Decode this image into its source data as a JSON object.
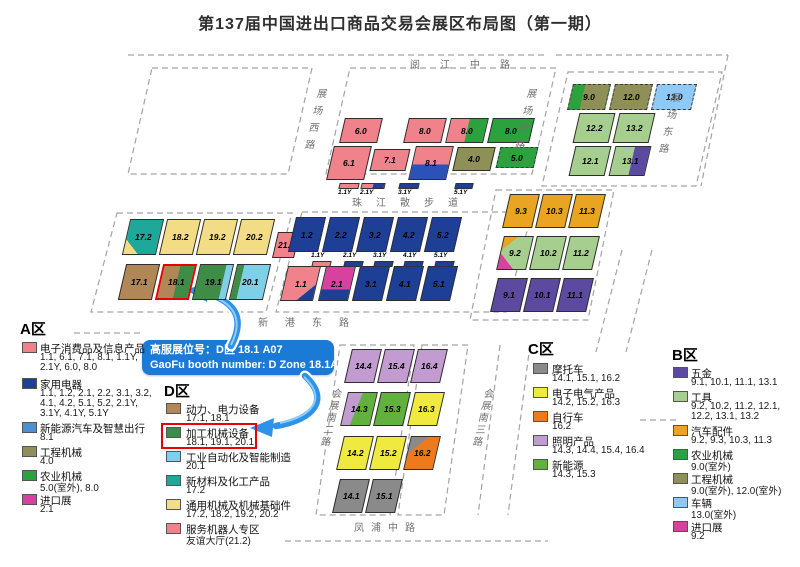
{
  "title": "第137届中国进出口商品交易会展区布局图（第一期）",
  "callout": {
    "x": 142,
    "y": 340,
    "w": 192,
    "h": 35,
    "bg": "#1B7AD6",
    "line1": "高服展位号：D区 18.1 A07",
    "line2": "GaoFu booth number: D Zone 18.1A07"
  },
  "colors": {
    "electronics_pink": "#F0828C",
    "appliance_blue": "#1E3F96",
    "nev_blue": "#4A90D2",
    "machinery_olive": "#8F8F58",
    "agri_green": "#2CA23E",
    "import_magenta": "#D8429E",
    "power_brown": "#B18758",
    "processing_green": "#3F8C46",
    "automation_lblue": "#7ED0E8",
    "materials_teal": "#1FA89A",
    "general_yellow": "#F3DC86",
    "moto_gray": "#8A8A8A",
    "electric_yellow": "#EFE940",
    "bicycle_orange": "#ED7B1E",
    "lighting_purple": "#C29BD0",
    "newenergy_green": "#62B13E",
    "hardware_purple": "#5C4AA0",
    "tools_lgreen": "#A6CF8F",
    "autoparts_amber": "#E9A421",
    "vehicle_lblue": "#8FC9F5",
    "callout_blue": "#1B7AD6",
    "highlight_red": "#E80000"
  },
  "map": {
    "roads": [
      {
        "text": "阅江中路",
        "x": 410,
        "y": 56,
        "dir": "h",
        "spacing": 20
      },
      {
        "text": "珠江散步道",
        "x": 352,
        "y": 194,
        "dir": "h",
        "spacing": 14
      },
      {
        "text": "新港东路",
        "x": 258,
        "y": 314,
        "dir": "h",
        "spacing": 17
      },
      {
        "text": "凤浦中路",
        "x": 354,
        "y": 519,
        "dir": "h",
        "spacing": 7
      },
      {
        "text": "展场西路",
        "x": 306,
        "y": 88,
        "dir": "v",
        "spacing": 7
      },
      {
        "text": "展场中路",
        "x": 516,
        "y": 88,
        "dir": "v",
        "spacing": 7
      },
      {
        "text": "展场东路",
        "x": 660,
        "y": 92,
        "dir": "v",
        "spacing": 7
      },
      {
        "text": "会展南二路",
        "x": 322,
        "y": 388,
        "dir": "v",
        "spacing": 2
      },
      {
        "text": "会展南三路",
        "x": 474,
        "y": 388,
        "dir": "v",
        "spacing": 2
      }
    ],
    "halls": [
      {
        "id": "6.0",
        "x": 342,
        "y": 118,
        "w": 38,
        "h": 25,
        "bg": "#F0828C"
      },
      {
        "id": "8.0",
        "x": 406,
        "y": 118,
        "w": 38,
        "h": 25,
        "bg": "#F0828C"
      },
      {
        "id": "8.0",
        "x": 448,
        "y": 118,
        "w": 38,
        "h": 25,
        "bg": "linear-gradient(90deg,#F0828C 50%,#2CA23E 50%)"
      },
      {
        "id": "8.0",
        "x": 490,
        "y": 118,
        "w": 42,
        "h": 25,
        "bg": "#2CA23E"
      },
      {
        "id": "6.1",
        "x": 330,
        "y": 146,
        "w": 38,
        "h": 34,
        "bg": "#F0828C"
      },
      {
        "id": "7.1",
        "x": 372,
        "y": 149,
        "w": 36,
        "h": 22,
        "bg": "#F0828C"
      },
      {
        "id": "8.1",
        "x": 412,
        "y": 146,
        "w": 38,
        "h": 34,
        "bg": "linear-gradient(180deg,#F0828C 55%,#2A52B8 55%)"
      },
      {
        "id": "4.0",
        "x": 455,
        "y": 147,
        "w": 38,
        "h": 24,
        "bg": "#8F8F58"
      },
      {
        "id": "5.0",
        "x": 498,
        "y": 147,
        "w": 38,
        "h": 21,
        "bg": "#2CA23E",
        "dashed": true
      },
      {
        "id": "9.0",
        "x": 570,
        "y": 84,
        "w": 38,
        "h": 26,
        "bg": "linear-gradient(90deg,#2CA23E 32%,#8F8F58 32%)",
        "dashed": true
      },
      {
        "id": "12.0",
        "x": 612,
        "y": 84,
        "w": 38,
        "h": 26,
        "bg": "#8F8F58",
        "dashed": true
      },
      {
        "id": "13.0",
        "x": 654,
        "y": 84,
        "w": 40,
        "h": 26,
        "bg": "#8FC9F5",
        "dashed": true
      },
      {
        "id": "12.2",
        "x": 576,
        "y": 113,
        "w": 36,
        "h": 30,
        "bg": "#A6CF8F"
      },
      {
        "id": "13.2",
        "x": 616,
        "y": 113,
        "w": 36,
        "h": 30,
        "bg": "#A6CF8F"
      },
      {
        "id": "12.1",
        "x": 572,
        "y": 146,
        "w": 36,
        "h": 30,
        "bg": "#A6CF8F"
      },
      {
        "id": "13.1",
        "x": 612,
        "y": 146,
        "w": 36,
        "h": 30,
        "bg": "linear-gradient(90deg,#A6CF8F 55%,#5C4AA0 55%)"
      },
      {
        "id": "17.2",
        "x": 126,
        "y": 219,
        "w": 34,
        "h": 36,
        "bg": "linear-gradient(45deg,#F3DC86 22%,#1FA89A 22%)"
      },
      {
        "id": "18.2",
        "x": 163,
        "y": 219,
        "w": 34,
        "h": 36,
        "bg": "#F3DC86"
      },
      {
        "id": "19.2",
        "x": 200,
        "y": 219,
        "w": 34,
        "h": 36,
        "bg": "#F3DC86"
      },
      {
        "id": "20.2",
        "x": 237,
        "y": 219,
        "w": 34,
        "h": 36,
        "bg": "#F3DC86"
      },
      {
        "id": "21.2",
        "x": 275,
        "y": 232,
        "w": 22,
        "h": 26,
        "bg": "#F0828C"
      },
      {
        "id": "17.1",
        "x": 122,
        "y": 264,
        "w": 34,
        "h": 36,
        "bg": "#B18758"
      },
      {
        "id": "18.1",
        "x": 159,
        "y": 264,
        "w": 34,
        "h": 36,
        "bg": "linear-gradient(90deg,#B18758 52%,#3F8C46 52%)",
        "highlight": true
      },
      {
        "id": "19.1",
        "x": 196,
        "y": 264,
        "w": 34,
        "h": 36,
        "bg": "linear-gradient(90deg,#3F8C46 80%,#7ED0E8 80%)"
      },
      {
        "id": "20.1",
        "x": 233,
        "y": 264,
        "w": 34,
        "h": 36,
        "bg": "linear-gradient(90deg,#3F8C46 20%,#7ED0E8 20%)"
      },
      {
        "id": "1.2",
        "x": 292,
        "y": 217,
        "w": 30,
        "h": 35,
        "bg": "#1E3F96"
      },
      {
        "id": "2.2",
        "x": 326,
        "y": 217,
        "w": 30,
        "h": 35,
        "bg": "#1E3F96"
      },
      {
        "id": "3.2",
        "x": 360,
        "y": 217,
        "w": 30,
        "h": 35,
        "bg": "#1E3F96"
      },
      {
        "id": "4.2",
        "x": 394,
        "y": 217,
        "w": 30,
        "h": 35,
        "bg": "#1E3F96"
      },
      {
        "id": "5.2",
        "x": 428,
        "y": 217,
        "w": 30,
        "h": 35,
        "bg": "#1E3F96"
      },
      {
        "id": "1.1",
        "x": 284,
        "y": 266,
        "w": 33,
        "h": 35,
        "bg": "linear-gradient(315deg,#1E3F96 24%,#F0828C 24%)"
      },
      {
        "id": "2.1",
        "x": 322,
        "y": 266,
        "w": 30,
        "h": 35,
        "bg": "linear-gradient(180deg,#D8429E 68%,#1E3F96 68%)"
      },
      {
        "id": "3.1",
        "x": 356,
        "y": 266,
        "w": 30,
        "h": 35,
        "bg": "#1E3F96"
      },
      {
        "id": "4.1",
        "x": 390,
        "y": 266,
        "w": 30,
        "h": 35,
        "bg": "#1E3F96"
      },
      {
        "id": "5.1",
        "x": 424,
        "y": 266,
        "w": 30,
        "h": 35,
        "bg": "#1E3F96"
      },
      {
        "id": "9.3",
        "x": 506,
        "y": 194,
        "w": 30,
        "h": 34,
        "bg": "#E9A421"
      },
      {
        "id": "10.3",
        "x": 539,
        "y": 194,
        "w": 30,
        "h": 34,
        "bg": "#E9A421"
      },
      {
        "id": "11.3",
        "x": 572,
        "y": 194,
        "w": 30,
        "h": 34,
        "bg": "#E9A421"
      },
      {
        "id": "9.2",
        "x": 500,
        "y": 236,
        "w": 30,
        "h": 34,
        "bg": "linear-gradient(135deg,#E9A421 22%,rgba(0,0,0,0) 22%),linear-gradient(45deg,#D8429E 26%,rgba(0,0,0,0) 26%),linear-gradient(#A6CF8F,#A6CF8F)"
      },
      {
        "id": "10.2",
        "x": 533,
        "y": 236,
        "w": 30,
        "h": 34,
        "bg": "#A6CF8F"
      },
      {
        "id": "11.2",
        "x": 566,
        "y": 236,
        "w": 30,
        "h": 34,
        "bg": "#A6CF8F"
      },
      {
        "id": "9.1",
        "x": 494,
        "y": 278,
        "w": 30,
        "h": 34,
        "bg": "#5C4AA0"
      },
      {
        "id": "10.1",
        "x": 527,
        "y": 278,
        "w": 30,
        "h": 34,
        "bg": "#5C4AA0"
      },
      {
        "id": "11.1",
        "x": 560,
        "y": 278,
        "w": 30,
        "h": 34,
        "bg": "#5C4AA0"
      },
      {
        "id": "14.4",
        "x": 348,
        "y": 349,
        "w": 30,
        "h": 34,
        "bg": "#C29BD0"
      },
      {
        "id": "15.4",
        "x": 381,
        "y": 349,
        "w": 30,
        "h": 34,
        "bg": "#C29BD0"
      },
      {
        "id": "16.4",
        "x": 414,
        "y": 349,
        "w": 30,
        "h": 34,
        "bg": "#C29BD0"
      },
      {
        "id": "14.3",
        "x": 344,
        "y": 392,
        "w": 30,
        "h": 34,
        "bg": "linear-gradient(100deg,#C29BD0 42%,#62B13E 42%)"
      },
      {
        "id": "15.3",
        "x": 377,
        "y": 392,
        "w": 30,
        "h": 34,
        "bg": "#62B13E"
      },
      {
        "id": "16.3",
        "x": 411,
        "y": 392,
        "w": 30,
        "h": 34,
        "bg": "#EFE940"
      },
      {
        "id": "14.2",
        "x": 340,
        "y": 436,
        "w": 30,
        "h": 34,
        "bg": "#EFE940"
      },
      {
        "id": "15.2",
        "x": 373,
        "y": 436,
        "w": 30,
        "h": 34,
        "bg": "#EFE940"
      },
      {
        "id": "16.2",
        "x": 407,
        "y": 436,
        "w": 30,
        "h": 34,
        "bg": "linear-gradient(135deg,#8A8A8A 28%,#ED7B1E 28%)"
      },
      {
        "id": "14.1",
        "x": 336,
        "y": 479,
        "w": 30,
        "h": 34,
        "bg": "#8A8A8A"
      },
      {
        "id": "15.1",
        "x": 369,
        "y": 479,
        "w": 30,
        "h": 34,
        "bg": "#8A8A8A"
      }
    ],
    "ybars": [
      {
        "id": "1.1Y",
        "x": 339,
        "y": 183,
        "w": 18,
        "bg": "#F0828C",
        "labelPos": "below"
      },
      {
        "id": "2.1Y",
        "x": 361,
        "y": 183,
        "w": 22,
        "bg": "linear-gradient(90deg,#F0828C 50%,#1E3F96 50%)",
        "labelPos": "below"
      },
      {
        "id": "3.1Y",
        "x": 399,
        "y": 183,
        "w": 18,
        "bg": "#1E3F96",
        "labelPos": "below"
      },
      {
        "id": "5.1Y",
        "x": 455,
        "y": 183,
        "w": 16,
        "bg": "#1E3F96",
        "labelPos": "below"
      },
      {
        "id": "1.1Y",
        "x": 312,
        "y": 261,
        "w": 17,
        "bg": "#F0828C",
        "labelPos": "above"
      },
      {
        "id": "2.1Y",
        "x": 344,
        "y": 261,
        "w": 17,
        "bg": "#1E3F96",
        "labelPos": "above"
      },
      {
        "id": "3.1Y",
        "x": 374,
        "y": 261,
        "w": 17,
        "bg": "#1E3F96",
        "labelPos": "above"
      },
      {
        "id": "4.1Y",
        "x": 404,
        "y": 261,
        "w": 17,
        "bg": "#1E3F96",
        "labelPos": "above"
      },
      {
        "id": "5.1Y",
        "x": 435,
        "y": 261,
        "w": 17,
        "bg": "#1E3F96",
        "labelPos": "above"
      }
    ]
  },
  "legends": [
    {
      "id": "A",
      "title": "A区",
      "x": 20,
      "y": 318,
      "sx": 22,
      "tx": 40,
      "items": [
        {
          "y": 341,
          "color": "#F0828C",
          "name": "电子消费品及信息产品",
          "nums": [
            "1.1, 6.1, 7.1, 8.1, 1.1Y,",
            "2.1Y, 6.0, 8.0"
          ]
        },
        {
          "y": 377,
          "color": "#1E3F96",
          "name": "家用电器",
          "nums": [
            "1.1, 1.2, 2.1, 2.2, 3.1, 3.2,",
            "4.1, 4.2, 5.1, 5.2, 2.1Y,",
            "3.1Y, 4.1Y, 5.1Y"
          ]
        },
        {
          "y": 421,
          "color": "#4A90D2",
          "name": "新能源汽车及智慧出行",
          "nums": [
            "8.1"
          ]
        },
        {
          "y": 445,
          "color": "#8F8F58",
          "name": "工程机械",
          "nums": [
            "4.0"
          ]
        },
        {
          "y": 469,
          "color": "#2CA23E",
          "name": "农业机械",
          "nums": [
            "5.0(室外), 8.0"
          ]
        },
        {
          "y": 493,
          "color": "#D8429E",
          "name": "进口展",
          "nums": [
            "2.1"
          ]
        }
      ]
    },
    {
      "id": "D",
      "title": "D区",
      "x": 164,
      "y": 380,
      "sx": 166,
      "tx": 186,
      "highlightBox": {
        "x": 161,
        "y": 423,
        "w": 96,
        "h": 26,
        "color": "#E80000"
      },
      "items": [
        {
          "y": 402,
          "color": "#B18758",
          "name": "动力、电力设备",
          "nums": [
            "17.1, 18.1"
          ]
        },
        {
          "y": 426,
          "color": "#3F8C46",
          "name": "加工机械设备",
          "nums": [
            "18.1, 19.1, 20.1"
          ],
          "highlighted": true
        },
        {
          "y": 450,
          "color": "#7ED0E8",
          "name": "工业自动化及智能制造",
          "nums": [
            "20.1"
          ]
        },
        {
          "y": 474,
          "color": "#1FA89A",
          "name": "新材料及化工产品",
          "nums": [
            "17.2"
          ]
        },
        {
          "y": 498,
          "color": "#F3DC86",
          "name": "通用机械及机械基础件",
          "nums": [
            "17.2, 18.2, 19.2, 20.2"
          ]
        },
        {
          "y": 522,
          "color": "#F0828C",
          "name": "服务机器人专区",
          "nums": [
            "友谊大厅(21.2)"
          ]
        }
      ]
    },
    {
      "id": "C",
      "title": "C区",
      "x": 528,
      "y": 338,
      "sx": 533,
      "tx": 552,
      "items": [
        {
          "y": 362,
          "color": "#8A8A8A",
          "name": "摩托车",
          "nums": [
            "14.1, 15.1, 16.2"
          ]
        },
        {
          "y": 386,
          "color": "#EFE940",
          "name": "电子电气产品",
          "nums": [
            "14.2, 15.2, 16.3"
          ]
        },
        {
          "y": 410,
          "color": "#ED7B1E",
          "name": "自行车",
          "nums": [
            "16.2"
          ]
        },
        {
          "y": 434,
          "color": "#C29BD0",
          "name": "照明产品",
          "nums": [
            "14.3, 14.4, 15.4, 16.4"
          ]
        },
        {
          "y": 458,
          "color": "#62B13E",
          "name": "新能源",
          "nums": [
            "14.3, 15.3"
          ]
        }
      ]
    },
    {
      "id": "B",
      "title": "B区",
      "x": 672,
      "y": 344,
      "sx": 673,
      "tx": 691,
      "items": [
        {
          "y": 366,
          "color": "#5C4AA0",
          "name": "五金",
          "nums": [
            "9.1, 10.1, 11.1, 13.1"
          ]
        },
        {
          "y": 390,
          "color": "#A6CF8F",
          "name": "工具",
          "nums": [
            "9.2, 10.2, 11.2, 12.1,",
            "12.2, 13.1, 13.2"
          ]
        },
        {
          "y": 424,
          "color": "#E9A421",
          "name": "汽车配件",
          "nums": [
            "9.2, 9.3, 10.3, 11.3"
          ]
        },
        {
          "y": 448,
          "color": "#2CA23E",
          "name": "农业机械",
          "nums": [
            "9.0(室外)"
          ]
        },
        {
          "y": 472,
          "color": "#8F8F58",
          "name": "工程机械",
          "nums": [
            "9.0(室外), 12.0(室外)"
          ]
        },
        {
          "y": 496,
          "color": "#8FC9F5",
          "name": "车辆",
          "nums": [
            "13.0(室外)"
          ]
        },
        {
          "y": 520,
          "color": "#D8429E",
          "name": "进口展",
          "nums": [
            "9.2"
          ]
        }
      ]
    }
  ]
}
